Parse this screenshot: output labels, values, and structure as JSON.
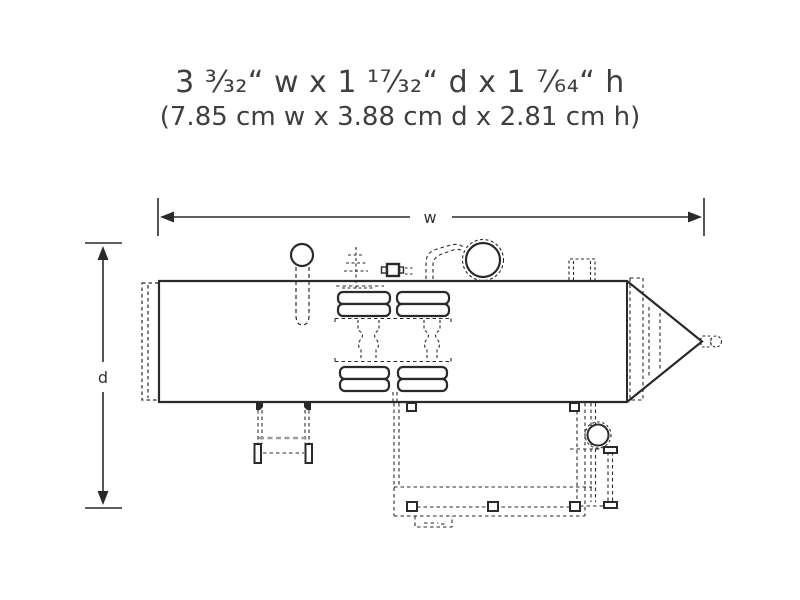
{
  "title": {
    "line1": "3 ³⁄₃₂“ w x 1 ¹⁷⁄₃₂“ d x 1 ⁷⁄₆₄“ h",
    "line2": "(7.85 cm w x 3.88 cm d x 2.81 cm h)"
  },
  "dimensions": {
    "width_label": "w",
    "depth_label": "d"
  },
  "drawing": {
    "description": "top-view dimensional line drawing of locomotive-style product",
    "ink_color": "#2a2a2a",
    "muted_color": "#9a9a9a",
    "background": "#ffffff"
  }
}
